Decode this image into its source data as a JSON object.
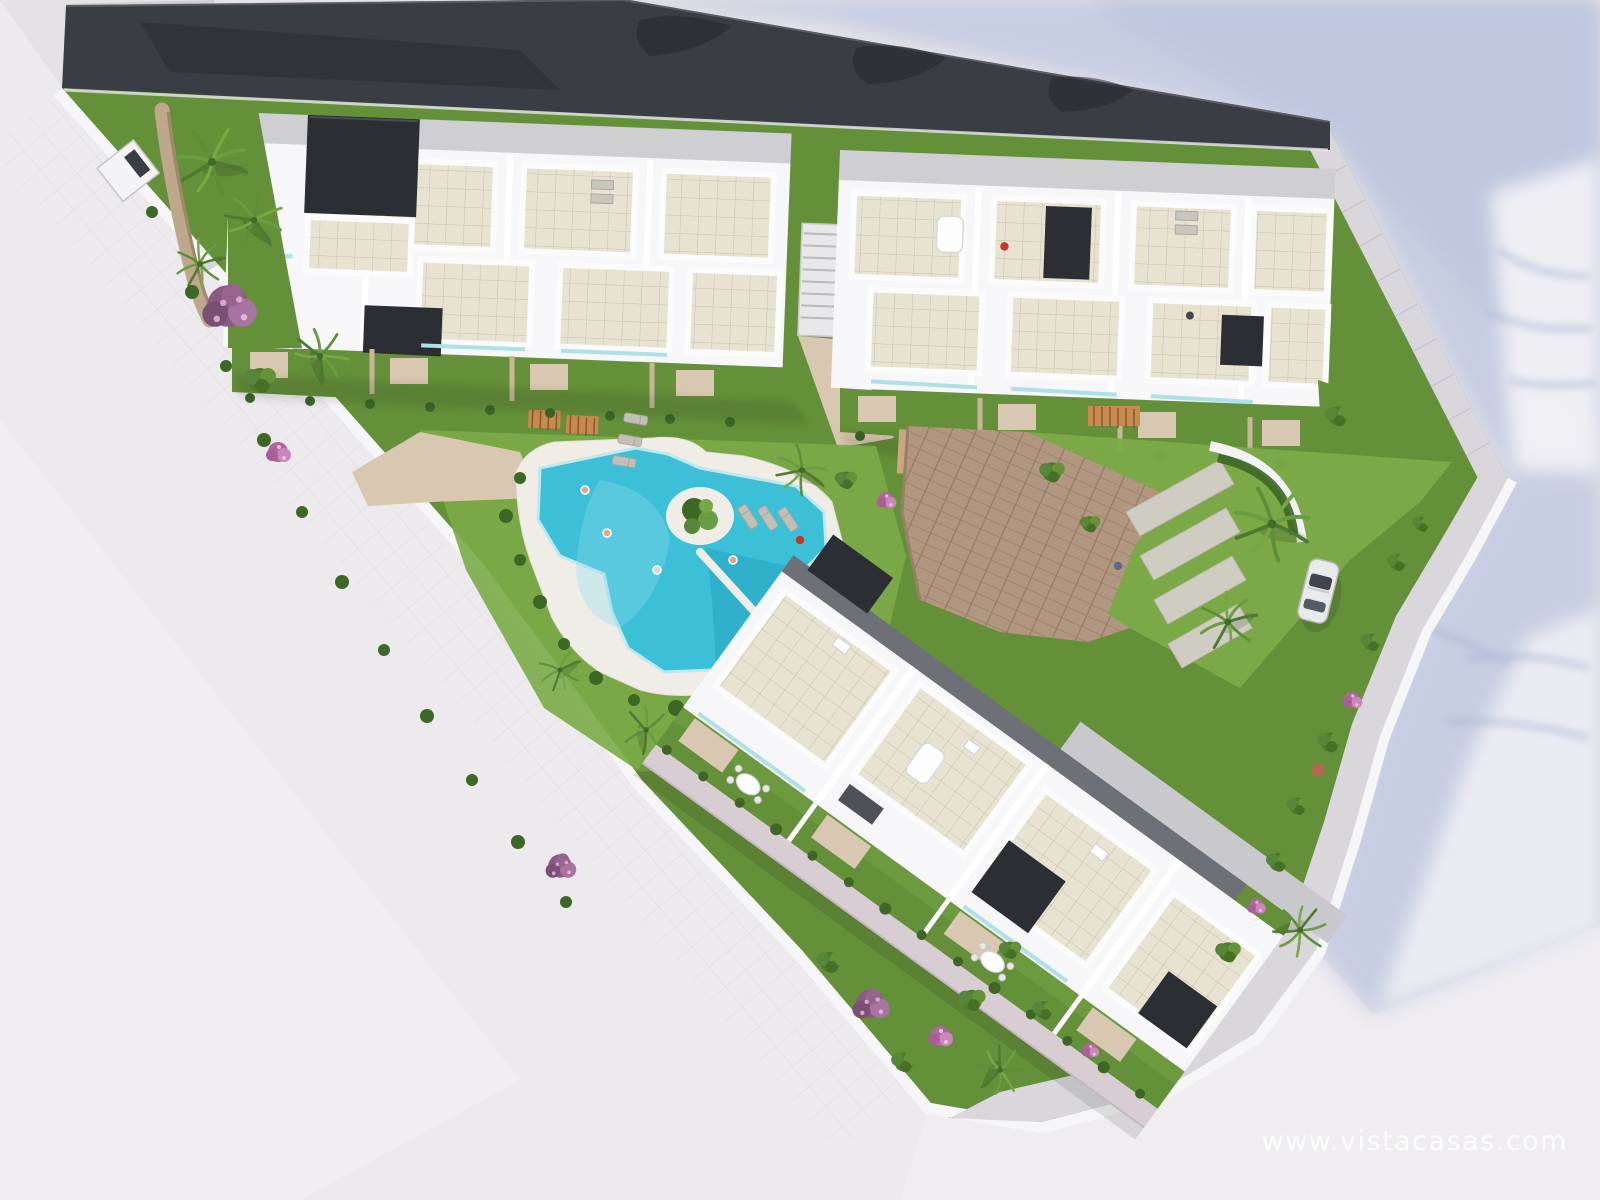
{
  "scene": {
    "type": "3d-aerial-architectural-render",
    "description": "Aerial 3D render of a triangular residential development plot: two rows of white townhouses with beige roof terraces and dark stair cores, a communal free-form swimming pool with sun deck and loungers, landscaped gardens with palm trees and flowering shrubs, a paved driveway and parking court with a parked car, surrounded by light streets with long blue cast shadows",
    "watermark": {
      "text": "www.vistacasas.com"
    }
  },
  "palette": {
    "bg": "#e4e2e6",
    "street": "#eceaed",
    "street_light": "#f1eff2",
    "shadow_blue": "#c4cce2",
    "shadow_blue_deep": "#b7c1dc",
    "sun_patch": "#f4f3f6",
    "roof_dark": "#3a3d43",
    "roof_light": "#cfced2",
    "wall_white": "#f7f6f8",
    "wall_shade": "#cfced3",
    "charcoal": "#2b2e33",
    "facade_shade": "#6e7078",
    "grass": "#65903a",
    "grass_light": "#7cab48",
    "hedge": "#3c6725",
    "water": "#3cc0d8",
    "water_deep": "#28a9c6",
    "water_light": "#8fdcea",
    "deck": "#f0ede6",
    "path_tan": "#d8c8b1",
    "paving_brown": "#b1977f",
    "sidewalk": "#d9d7db",
    "walk_mauve": "#d8cdd3",
    "stone_wall": "#bda88c",
    "parking_pad": "#cfccc2",
    "drive_gray": "#c9c8cd",
    "car_body": "#e9eaec",
    "pergola_wood": "#c98a50",
    "flower_purple": "#97638f",
    "flower_pink": "#cd86bb",
    "watermark": "#ffffff"
  }
}
